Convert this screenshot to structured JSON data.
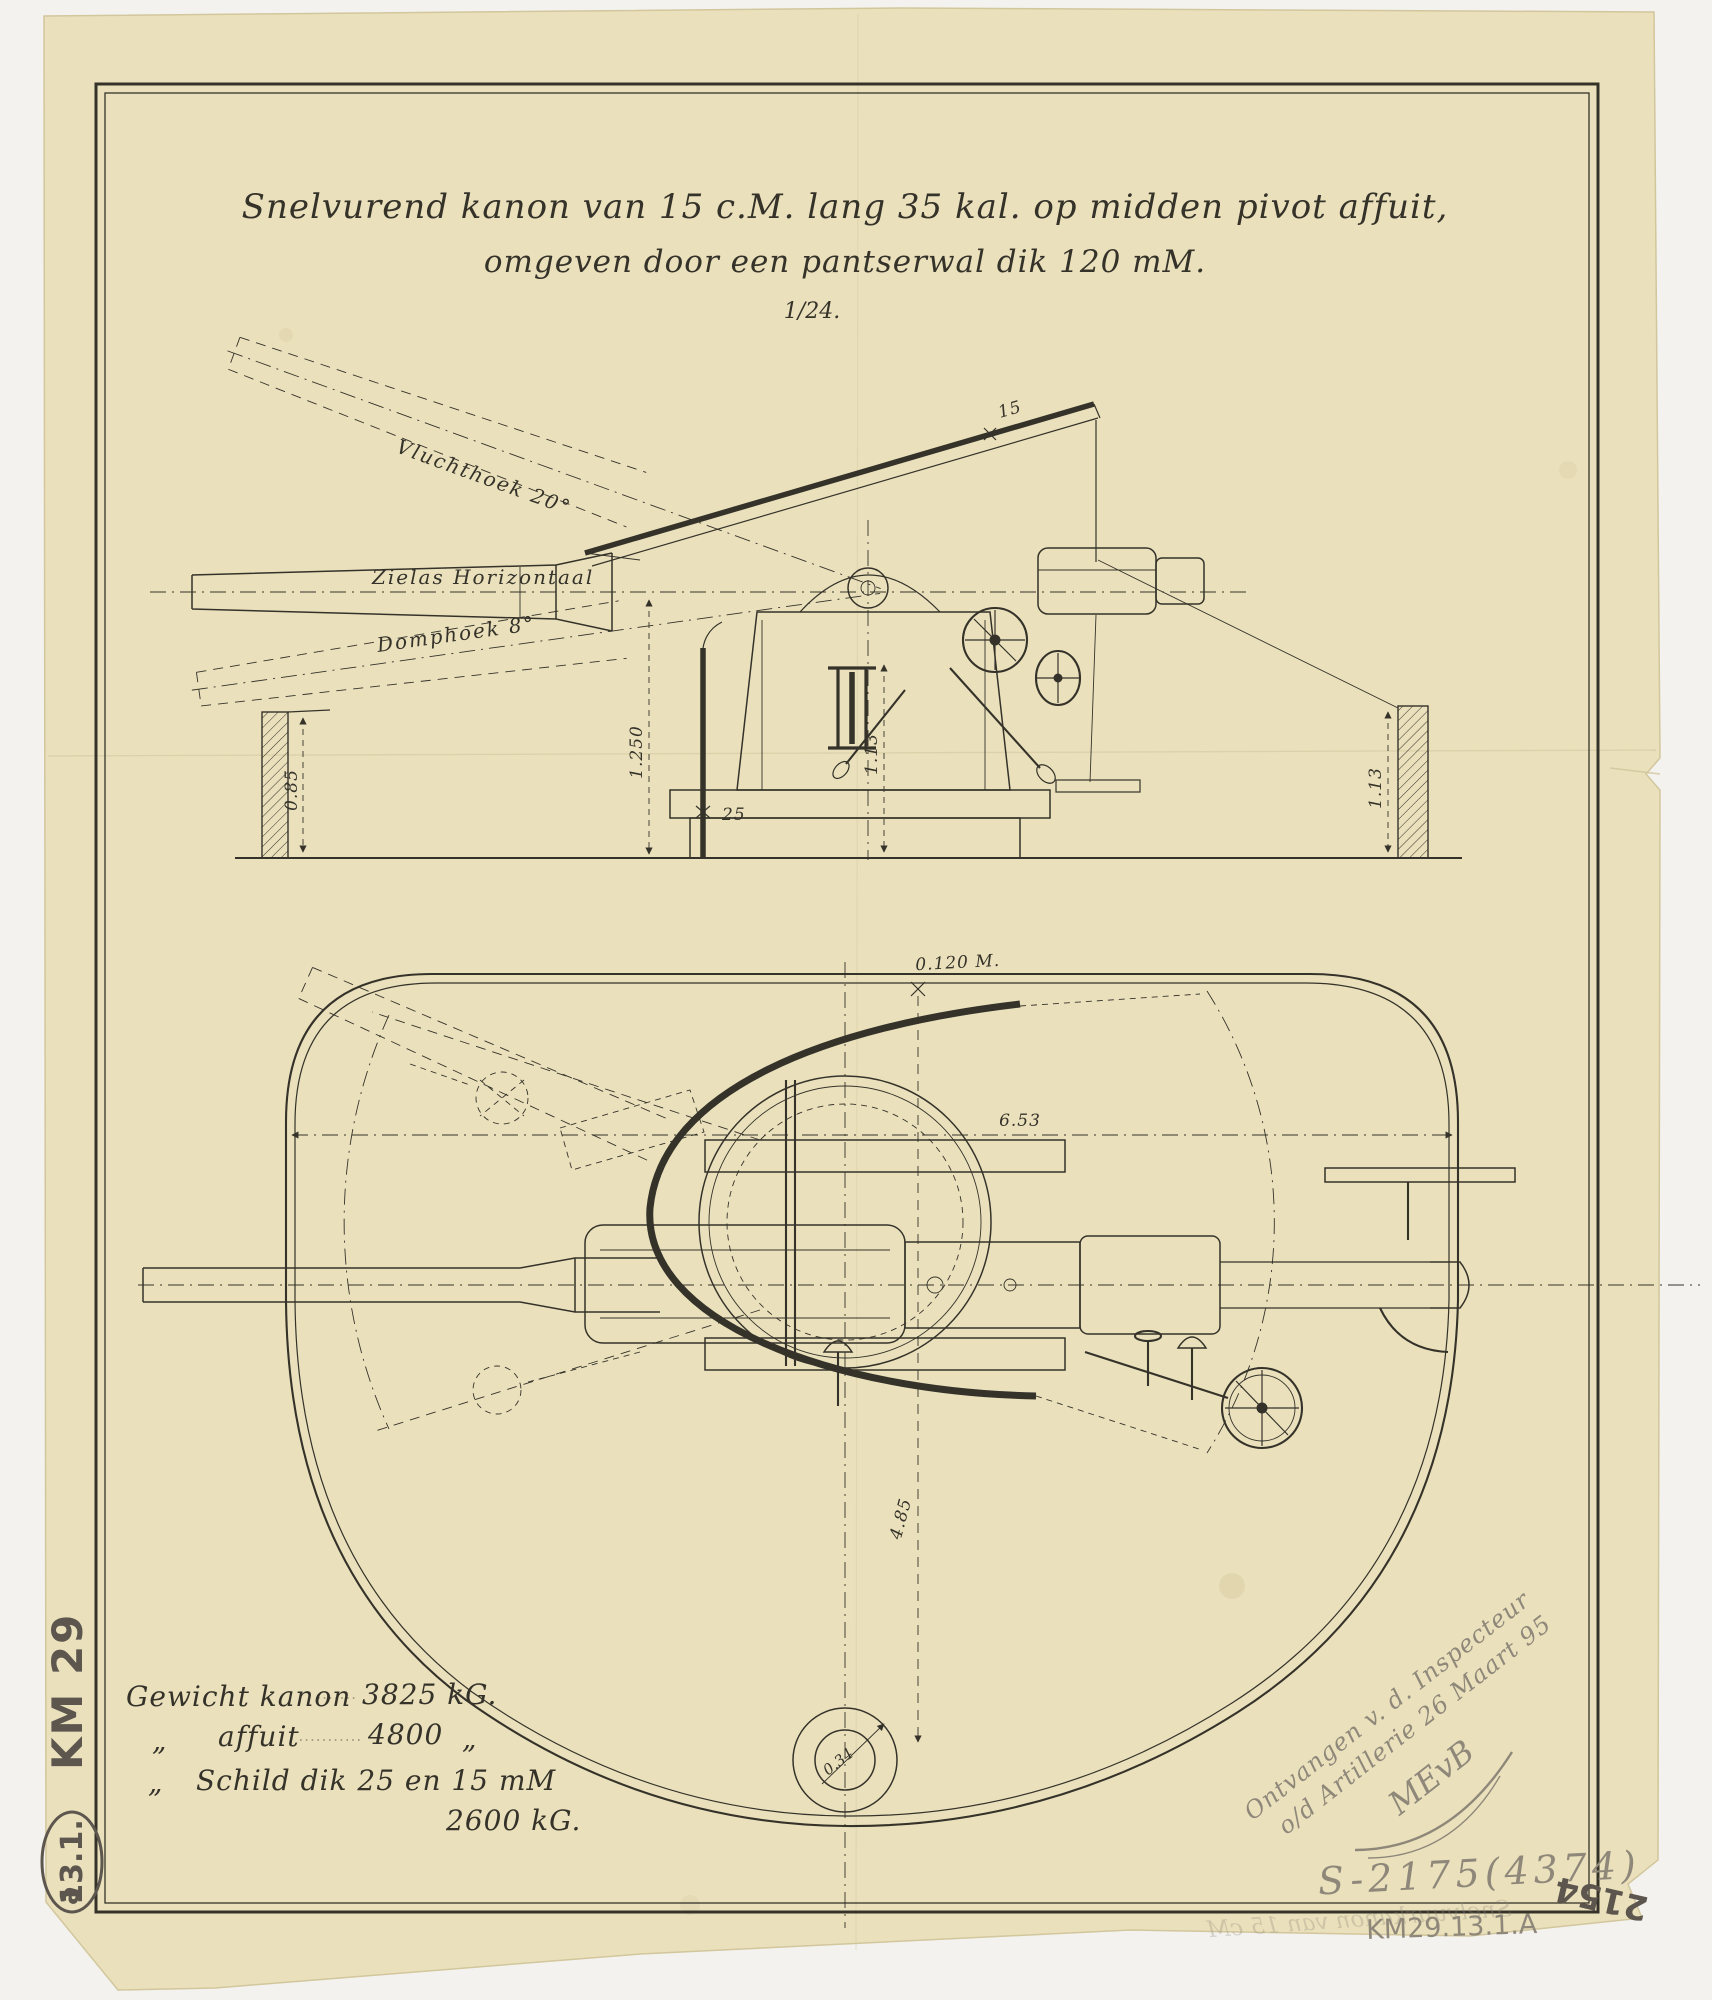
{
  "colors": {
    "scan_background": "#f3f2ee",
    "paper": "#eae1bc",
    "paper_edge": "#d2c69c",
    "ink": "#35322a",
    "pencil": "#8f887a",
    "pencil_dark": "#5c564e",
    "crease": "#cfc49b"
  },
  "title": {
    "line1": "Snelvurend kanon van 15 c.M. lang 35 kal. op midden pivot affuit,",
    "line2": "omgeven door een pantserwal dik 120 mM.",
    "scale": "1/24."
  },
  "elevation": {
    "vluchthoek_label": "Vluchthoek 20°",
    "zielas_label": "Zielas Horizontaal",
    "domphoek_label": "Domphoek 8°",
    "dim_shield_roof": "15",
    "dim_shield_front": "25",
    "dim_height_center": "1.250",
    "dim_height_inner": "1.13",
    "dim_wall_left": "0.85",
    "dim_wall_right": "1.13"
  },
  "plan": {
    "dim_wall_thickness": "0.120 M.",
    "dim_diameter": "6.53",
    "dim_radius_depth": "4.85",
    "dim_pivot_hole": "0.34"
  },
  "weights": {
    "row1_label": "Gewicht kanon",
    "row1_value": "3825 kG.",
    "ditto": "„",
    "row2_label": "affuit",
    "row2_value": "4800",
    "row3_label": "Schild dik 25 en 15 mM",
    "row4_value": "2600 kG."
  },
  "annotations": {
    "received_line1": "Ontvangen v. d. Inspecteur",
    "received_line2": "o/d Artillerie 26 Maart 95",
    "signature": "MEvB",
    "registry_number": "S-2175(4374)",
    "inventory_number": "KM29.13.1.A",
    "corner_number": "2154",
    "bleed_through": "Snelvuurkanon van 15 cM",
    "margin_collection": "KM 29",
    "margin_item": "13.1.",
    "margin_suffix": "a"
  }
}
